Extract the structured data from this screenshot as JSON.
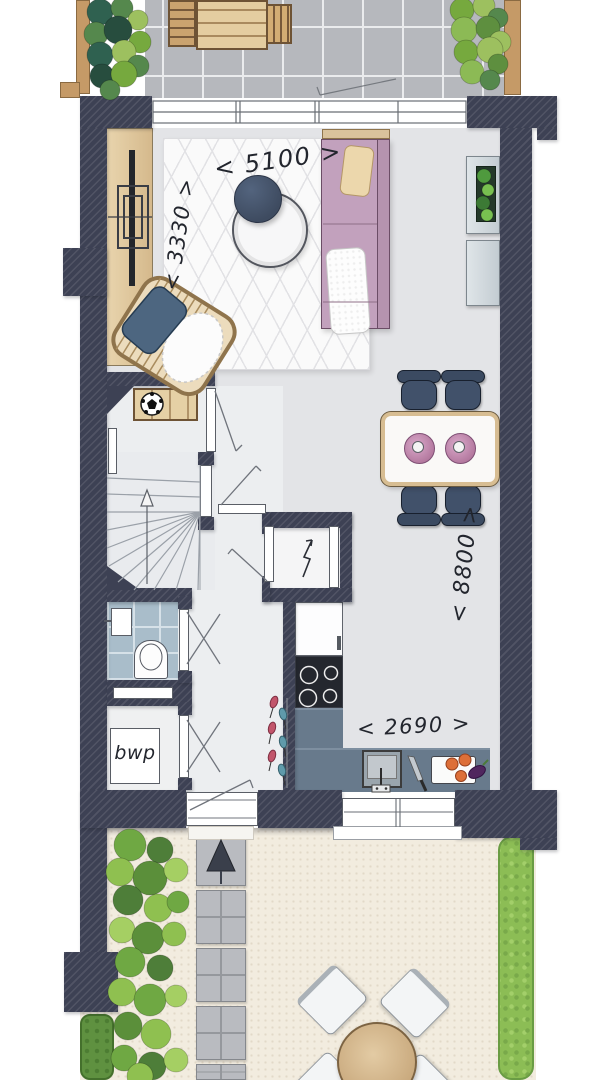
{
  "floor_plan": {
    "dimension_labels": {
      "living_width": "< 5100 >",
      "living_depth": "< 3330 >",
      "plan_depth": "< 8800 >",
      "kitchen_width": "< 2690 >"
    },
    "room_labels": {
      "utility_closet": "bwp"
    },
    "symbols": {
      "north_arrow": "north-arrow",
      "electric_meter": "lightning-bolt"
    },
    "colors": {
      "wall": "#3d4154",
      "interior_floor": "#e3e4e7",
      "hall_floor": "#eceef0",
      "terrace_tile": "#b6b8bd",
      "toilet_tile": "#a9bdca",
      "garden_ground": "#f2ecdf",
      "kitchen_counter": "#687a8c",
      "cooktop": "#24272e",
      "sofa": "#c2a1bd",
      "pillow": "#e9d5ab",
      "wood": "#e0c89d",
      "dining_chair": "#3d4c63",
      "plate": "#c890b8",
      "plant_dark": "#2f6150",
      "plant_light": "#9dc05f",
      "hedge": "#8cbd55"
    }
  }
}
